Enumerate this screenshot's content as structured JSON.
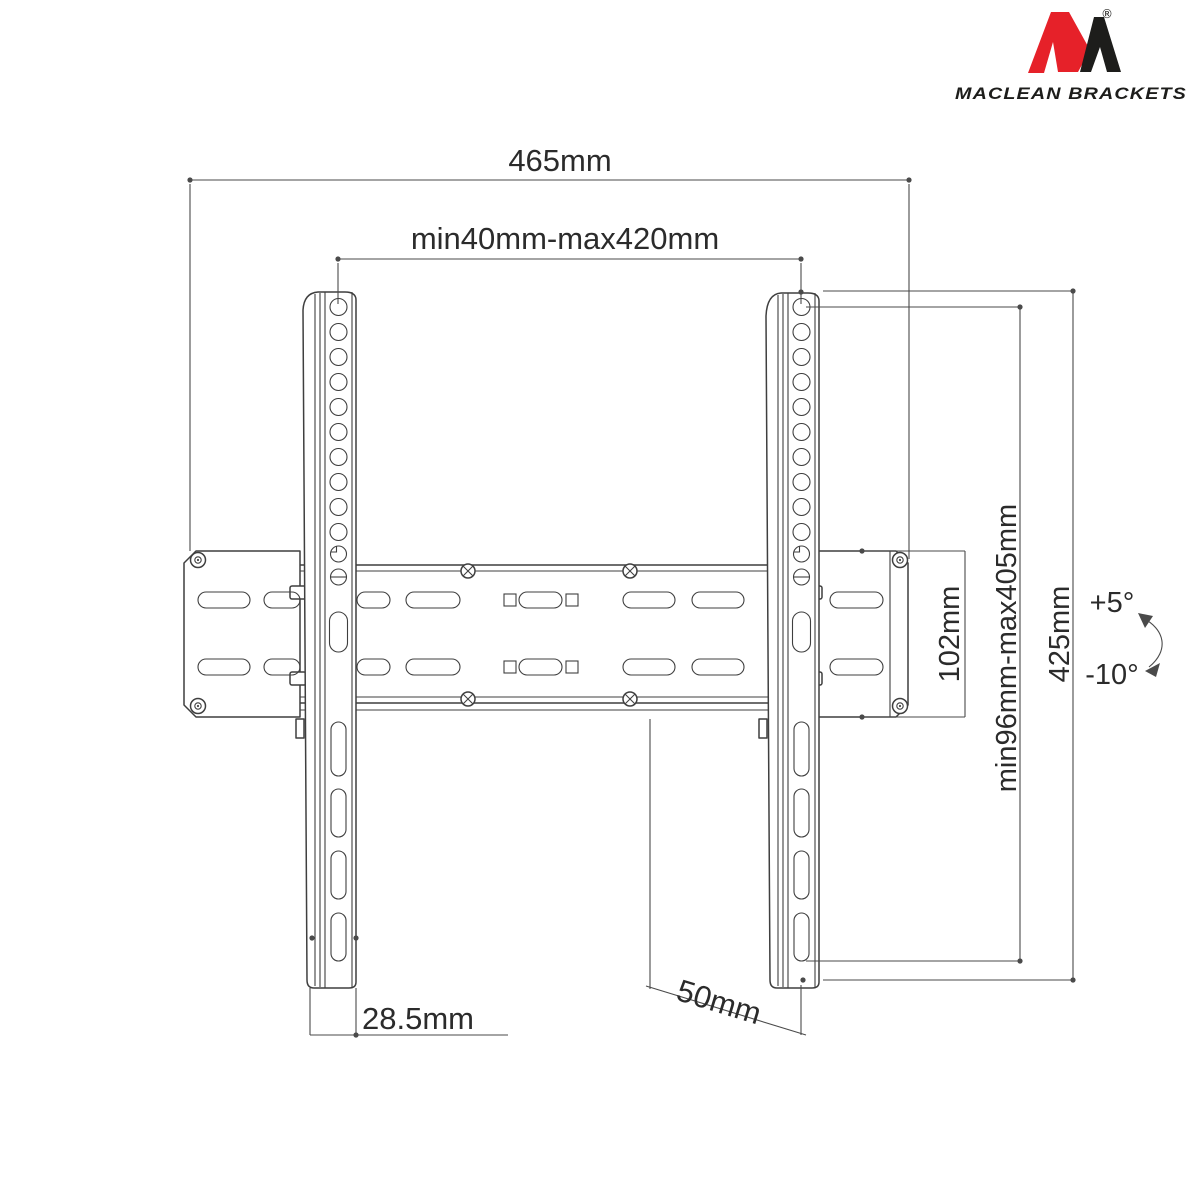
{
  "brand": {
    "name": "Maclean Brackets",
    "wordmark": "MACLEAN BRACKETS",
    "registered_mark": "®"
  },
  "drawing": {
    "labels": {
      "overall_width": "465mm",
      "horizontal_hole_pattern": "min40mm-max420mm",
      "wall_plate_height": "102mm",
      "vertical_hole_pattern": "min96mm-max405mm",
      "bracket_height": "425mm",
      "tilt_up": "+5°",
      "tilt_down": "-10°",
      "rail_bottom_width": "28.5mm",
      "wall_distance": "50mm"
    }
  },
  "colors": {
    "line": "#3f3f3f",
    "dimension": "#4a4a4a",
    "text": "#2b2b2b",
    "logo_red": "#e62129",
    "logo_black": "#1d1d1b",
    "background": "#ffffff"
  }
}
